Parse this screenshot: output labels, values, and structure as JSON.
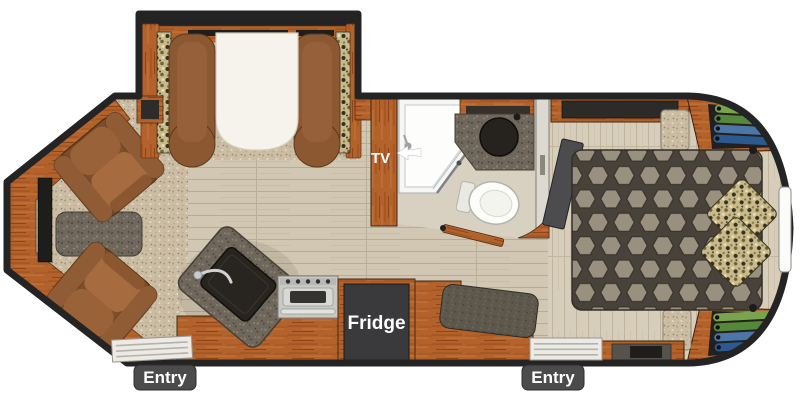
{
  "labels": {
    "tv": "TV",
    "fridge": "Fridge",
    "entry_left": "Entry",
    "entry_right": "Entry"
  },
  "colors": {
    "wall": "#242424",
    "wood_cabinet": "#b4622c",
    "floor_plank": "#d1c7b3",
    "carpet_speckle": "#cbbda4",
    "granite_counter": "#6f675b",
    "recliner_brown": "#8a5733",
    "sofa_mattress_white": "#f6f3ec",
    "bed_honeycomb_dark": "#48423a",
    "bed_honeycomb_cell": "#99907f",
    "camo_pillow": "#c9ba8c",
    "fridge_box": "#3a3a3c",
    "entry_badge": "#4b4b4b",
    "label_text": "#ffffff",
    "clothes_green": "#79a44d",
    "clothes_blue": "#4b76a6",
    "shower_white": "#f6f6f3"
  }
}
